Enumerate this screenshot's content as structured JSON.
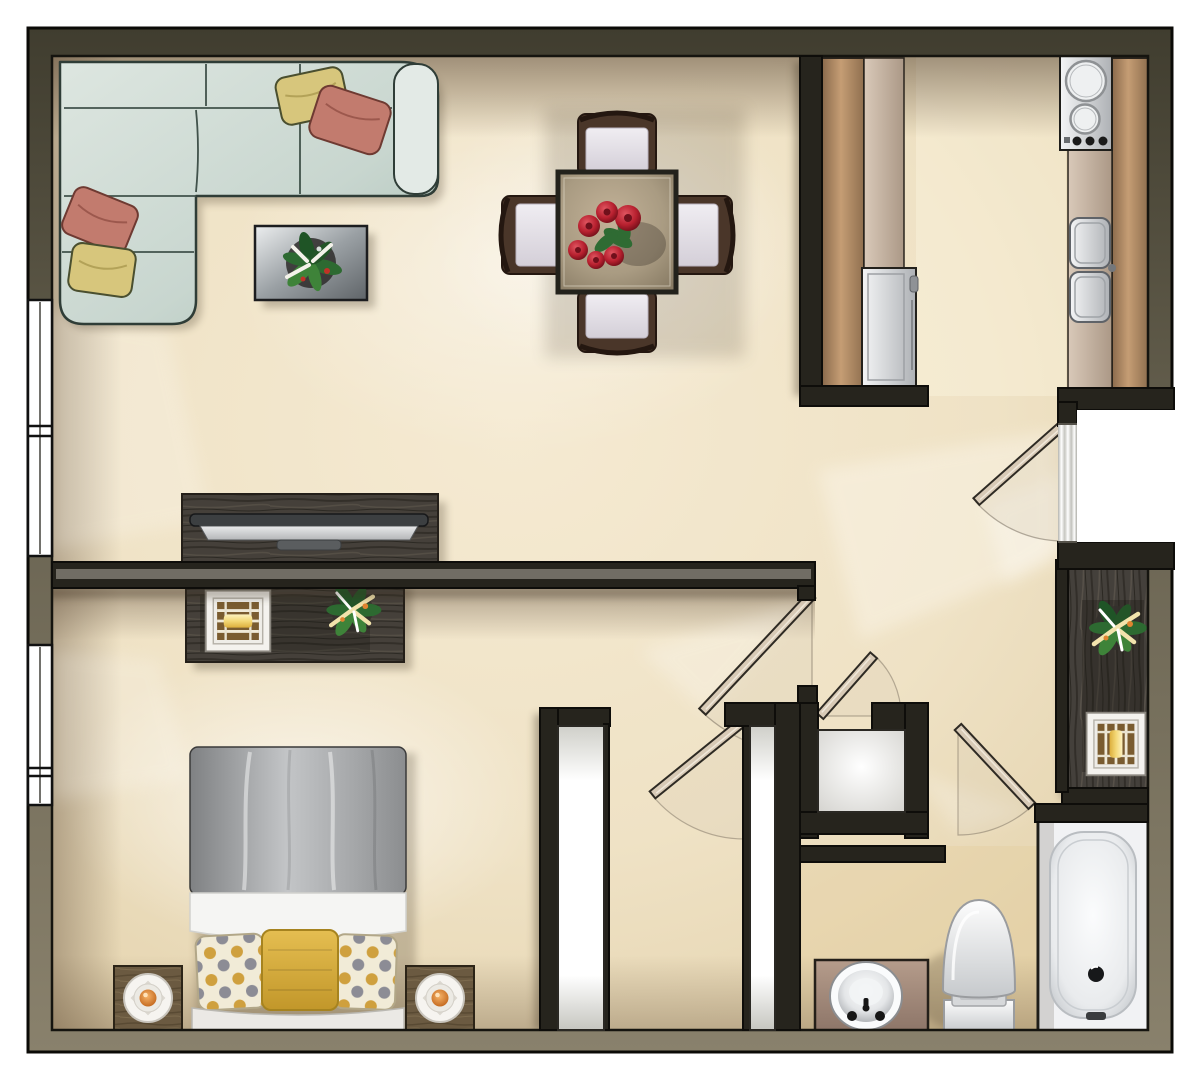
{
  "document": {
    "kind": "apartment-floor-plan-rendering",
    "style": "top-down color architectural rendering, no text labels"
  },
  "palette": {
    "background": "#ffffff",
    "floor": "#f0e3c8",
    "floor_light": "#f8efdd",
    "wall": "#26241d",
    "wall_band_dark": "#45412f",
    "wall_band_light": "#7d7662",
    "window_glass": "#ffffff",
    "sofa": "#ccd9d2",
    "sofa_outline": "#2f3d37",
    "pillow_yellow": "#d7c67c",
    "pillow_coral": "#c27b6e",
    "chair_wood": "#4a3629",
    "chair_cushion": "#e9e5ec",
    "rose": "#b7202f",
    "foliage": "#2f6b33",
    "counter_bronze": "#b48d67",
    "counter_light": "#cbb8a6",
    "stainless": "#c9cbcf",
    "wood_dark": "#45403a",
    "wood_night": "#6b5a41",
    "lamp_glow": "#eed27b",
    "lamp_orange": "#e08a3c",
    "bed_duvet": "#9b9d9f",
    "bed_linen": "#f5f5f3",
    "pillow_mustard": "#d8b13e",
    "pillow_dot_base": "#f1ebd7",
    "door_leaf": "#d8cab6",
    "vanity": "#a58d7d",
    "fixture": "#f1f2f4"
  },
  "rooms": [
    {
      "name": "living-room",
      "items": [
        "sectional-sofa",
        "throw-pillow x4",
        "coffee-table",
        "potted-plant",
        "tv-console",
        "television"
      ]
    },
    {
      "name": "dining-area",
      "items": [
        "dining-table",
        "dining-chair x4",
        "rose-centerpiece"
      ]
    },
    {
      "name": "kitchen",
      "items": [
        "cooktop",
        "double-basin-sink",
        "refrigerator",
        "bronze-counter x2"
      ]
    },
    {
      "name": "entry-hall",
      "items": [
        "entry-door",
        "console-table",
        "square-lamp",
        "potted-plant"
      ]
    },
    {
      "name": "bedroom",
      "items": [
        "bed",
        "polka-dot-pillow x2",
        "mustard-pillow",
        "dresser",
        "square-lamp",
        "potted-plant",
        "nightstand x2",
        "round-lamp x2"
      ]
    },
    {
      "name": "closets",
      "items": [
        "closet-door x2",
        "walk-in-closet-door",
        "linen-closet"
      ]
    },
    {
      "name": "bathroom",
      "items": [
        "bathtub",
        "toilet",
        "vanity-round-sink",
        "bathroom-door"
      ]
    }
  ],
  "architecture": {
    "windows": 2,
    "interior_doors": 4,
    "entry_doors": 1
  }
}
